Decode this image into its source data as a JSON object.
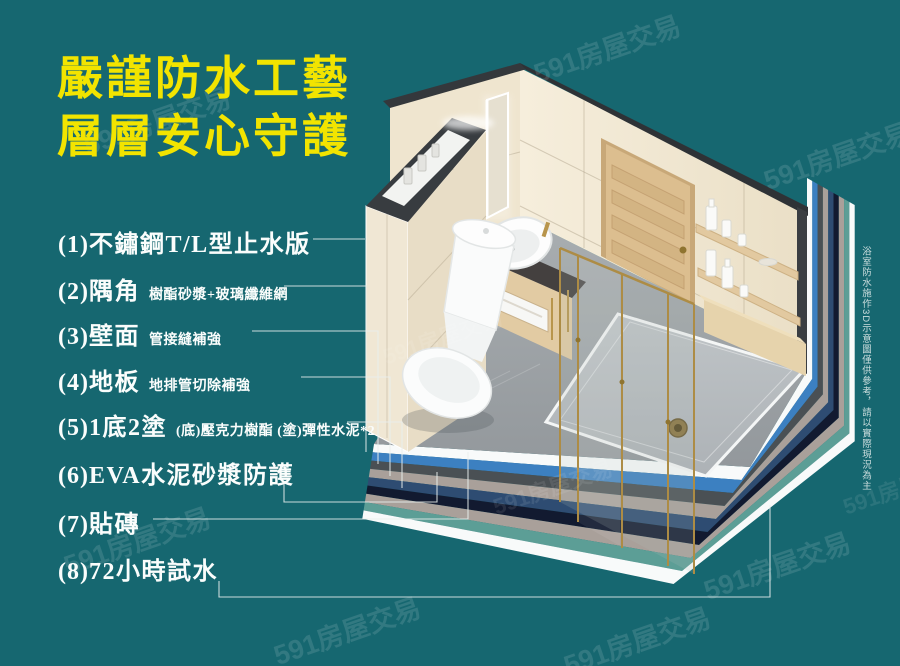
{
  "page": {
    "background_color": "#166770",
    "title_color": "#F2E400",
    "watermark_text": "591房屋交易"
  },
  "title": {
    "line1": "嚴謹防水工藝",
    "line2": "層層安心守護"
  },
  "list": {
    "items": [
      {
        "num": "(1)",
        "label": "不鏽鋼T/L型止水版",
        "note": ""
      },
      {
        "num": "(2)",
        "label": "隅角",
        "note": "樹酯砂漿+玻璃纖維網"
      },
      {
        "num": "(3)",
        "label": "壁面",
        "note": "管接縫補強"
      },
      {
        "num": "(4)",
        "label": "地板",
        "note": "地排管切除補強"
      },
      {
        "num": "(5)",
        "label": "1底2塗",
        "note": "(底)壓克力樹酯 (塗)彈性水泥*2"
      },
      {
        "num": "(6)",
        "label": "EVA水泥砂漿防護",
        "note": ""
      },
      {
        "num": "(7)",
        "label": "貼磚",
        "note": ""
      },
      {
        "num": "(8)",
        "label": "72小時試水",
        "note": ""
      }
    ]
  },
  "side_note": "浴室防水施作3D示意圖僅供參考，請以實際現況為主",
  "illustration": {
    "layer_colors": {
      "white": "#F8FAFA",
      "blue": "#3C80C1",
      "charcoal": "#4A5054",
      "taupe": "#A9A09A",
      "steel_navy": "#2E4C72",
      "dark_navy": "#121A30",
      "teal_green": "#5C9E96"
    }
  }
}
